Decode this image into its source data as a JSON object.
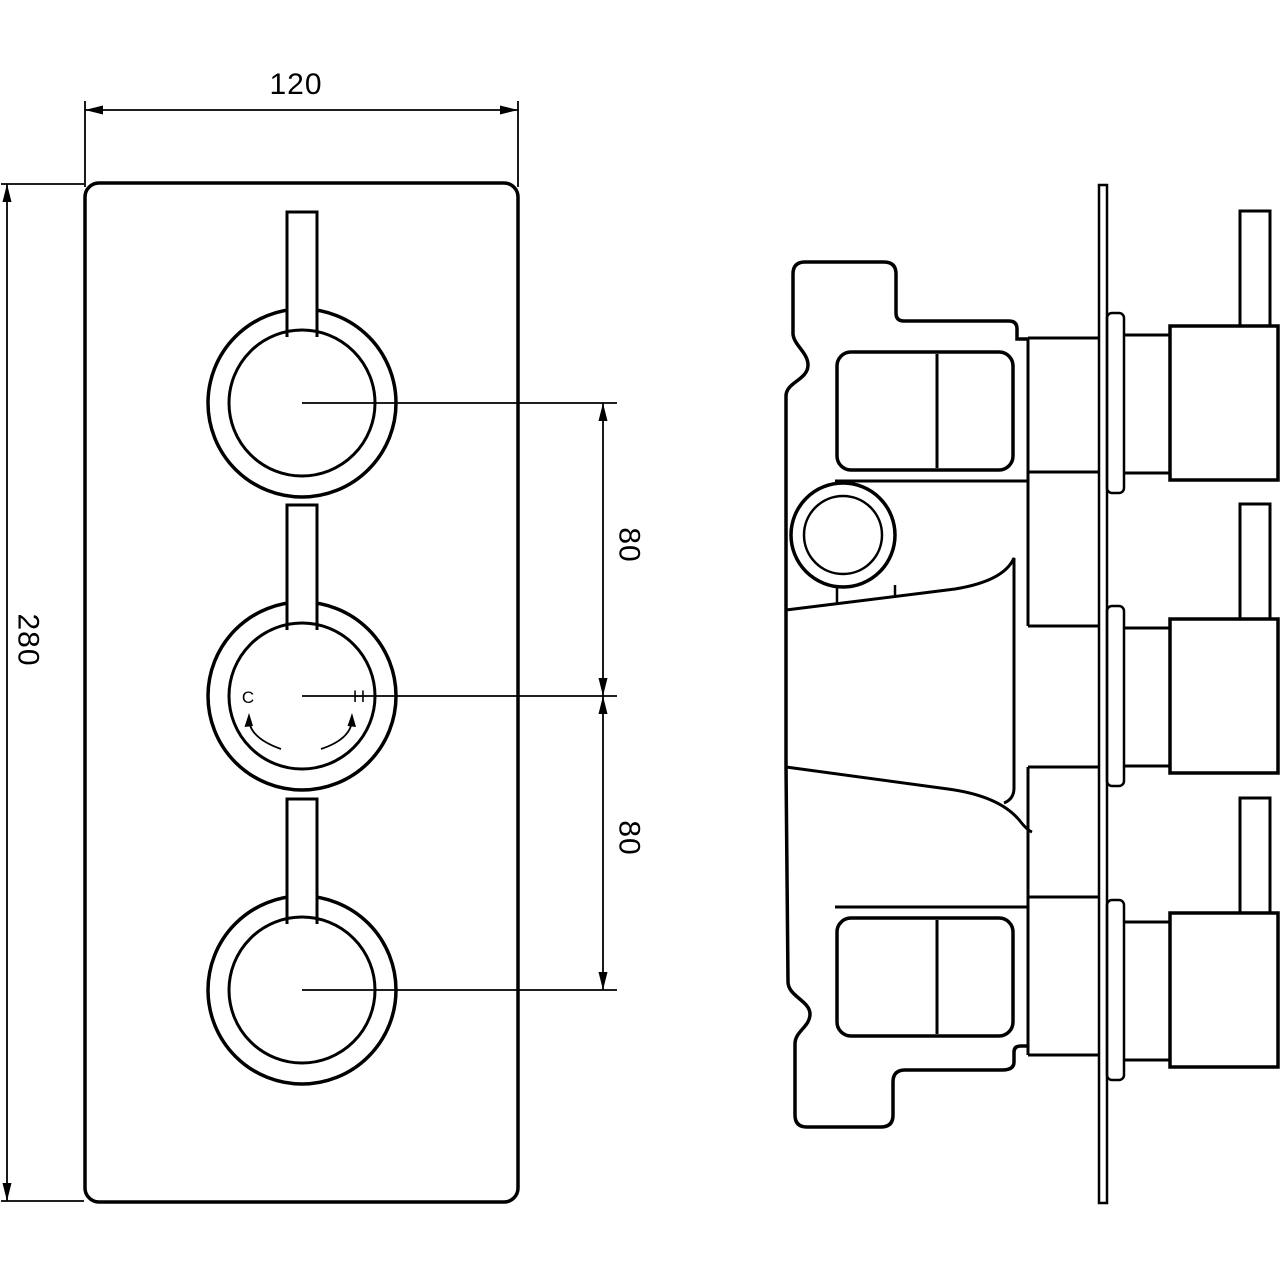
{
  "drawing": {
    "background": "#ffffff",
    "line_color": "#000000",
    "front_view": {
      "width_dim": "120",
      "height_dim": "280",
      "knob_spacing_top": "80",
      "knob_spacing_bottom": "80",
      "cold_indicator": "C",
      "hot_indicator": "H"
    }
  }
}
